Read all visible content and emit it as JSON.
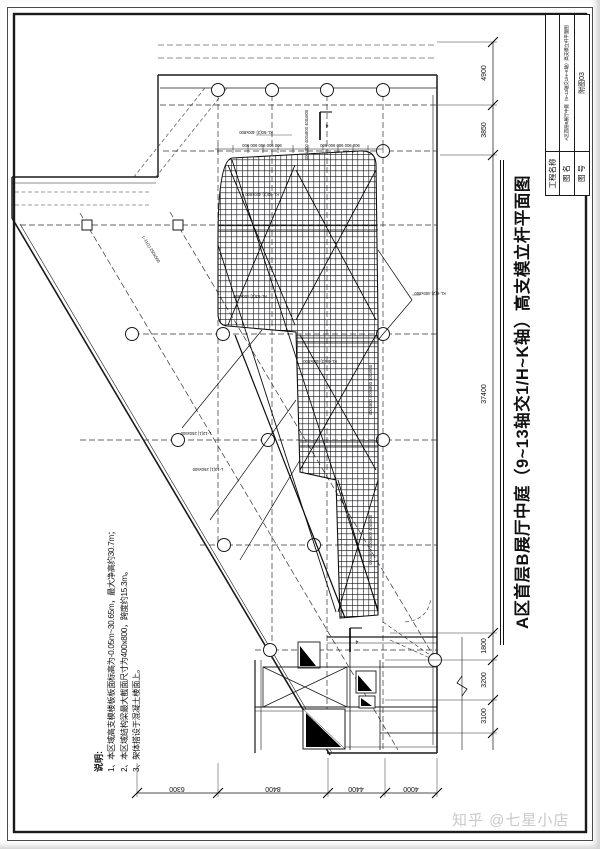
{
  "sheet": {
    "watermark": "知乎 @七星小店"
  },
  "title_block": {
    "project_label": "工程名称",
    "project_value": "",
    "name_label": "图 名",
    "name_value": "A区首层B展厅中庭（9~13轴交1/H~K轴）高支模立杆平面图",
    "number_label": "图 号",
    "number_value": "附图03"
  },
  "main_title": "A区首层B展厅中庭（9~13轴交1/H~K轴）高支模立杆平面图",
  "notes": {
    "heading": "说明:",
    "items": [
      "1、本区域高支模楼板板面标高为-0.05m~30.65m，最大净高约30.7m；",
      "2、本区域结构梁最大截面尺寸为400x800，跨度约15.3m。",
      "3、架体搭设于混凝土楼面上。"
    ]
  },
  "dimensions": {
    "right": [
      "4900",
      "3850",
      "37400",
      "1800",
      "3200",
      "3100"
    ],
    "bottom": [
      "6300",
      "8400",
      "4400",
      "4000"
    ],
    "spacing_row": "900 900 900 900 900"
  },
  "drawing_labels": {
    "section_mark": "4",
    "column_strip": "400x800 400x800 400x800",
    "beams": [
      "KL-50(3) 400x800",
      "KL-52(3) 400x800",
      "KL-53(3) 400x800",
      "KL-55(3) 400x800",
      "L-11(1) 250x500",
      "L-12(1) 250x500",
      "L-13(1) 250x500",
      "KL-6(2) 400x800"
    ]
  }
}
